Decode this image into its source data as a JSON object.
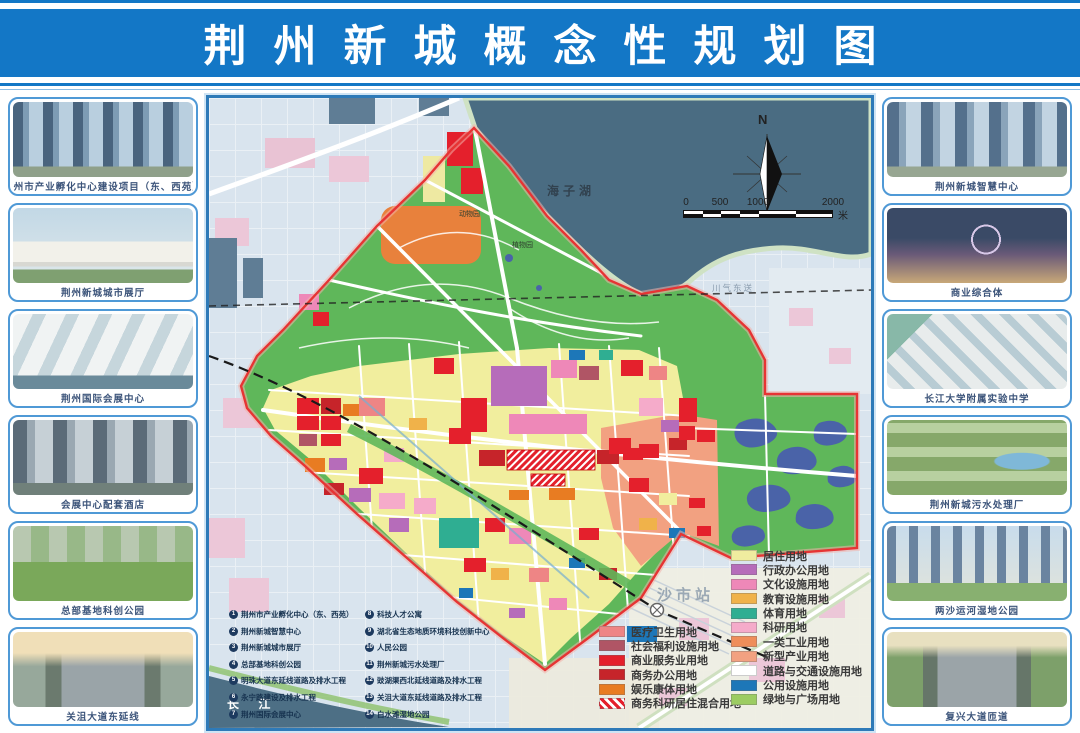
{
  "header": {
    "title": "荆州新城概念性规划图"
  },
  "left_panel": [
    {
      "caption": "荆州市产业孵化中心建设项目（东、西苑）"
    },
    {
      "caption": "荆州新城城市展厅"
    },
    {
      "caption": "荆州国际会展中心"
    },
    {
      "caption": "会展中心配套酒店"
    },
    {
      "caption": "总部基地科创公园"
    },
    {
      "caption": "关沮大道东延线"
    }
  ],
  "right_panel": [
    {
      "caption": "荆州新城智慧中心"
    },
    {
      "caption": "商业综合体"
    },
    {
      "caption": "长江大学附属实验中学"
    },
    {
      "caption": "荆州新城污水处理厂"
    },
    {
      "caption": "两沙运河湿地公园"
    },
    {
      "caption": "复兴大道匝道"
    }
  ],
  "map": {
    "labels": {
      "lake": "海子湖",
      "zoo": "动物园",
      "garden": "植物园",
      "pipeline": "川气东送",
      "station": "沙市站",
      "river": "长 江",
      "north": "N",
      "scale_unit": "米"
    },
    "scale_ticks": [
      "0",
      "500",
      "1000",
      "2000"
    ],
    "project_list": [
      {
        "n": "1",
        "t": "荆州市产业孵化中心（东、西苑）"
      },
      {
        "n": "2",
        "t": "荆州新城智慧中心"
      },
      {
        "n": "3",
        "t": "荆州新城城市展厅"
      },
      {
        "n": "4",
        "t": "总部基地科创公园"
      },
      {
        "n": "5",
        "t": "明珠大道东延线道路及排水工程"
      },
      {
        "n": "6",
        "t": "永宁路建设及排水工程"
      },
      {
        "n": "7",
        "t": "荆州国际会展中心"
      },
      {
        "n": "8",
        "t": "科技人才公寓"
      },
      {
        "n": "9",
        "t": "湖北省生态地质环境科技创新中心"
      },
      {
        "n": "10",
        "t": "人民公园"
      },
      {
        "n": "11",
        "t": "荆州新城污水处理厂"
      },
      {
        "n": "12",
        "t": "豉湖渠西北延线道路及排水工程"
      },
      {
        "n": "13",
        "t": "关沮大道东延线道路及排水工程"
      },
      {
        "n": "14",
        "t": "白水滩湿地公园"
      }
    ],
    "legend_left": [
      {
        "label": "医疗卫生用地",
        "bg": "#ee8585"
      },
      {
        "label": "社会福利设施用地",
        "bg": "#b05565"
      },
      {
        "label": "商业服务业用地",
        "bg": "#e4202c"
      },
      {
        "label": "商务办公用地",
        "bg": "#c6242a"
      },
      {
        "label": "娱乐康体用地",
        "bg": "#e87c22"
      },
      {
        "label": "商务科研居住混合用地",
        "bg": "repeating-linear-gradient(45deg,#e4202c 0 3px,#ffffff 3px 6px)"
      }
    ],
    "legend_right": [
      {
        "label": "居住用地",
        "bg": "#efec9f"
      },
      {
        "label": "行政办公用地",
        "bg": "#b66cba"
      },
      {
        "label": "文化设施用地",
        "bg": "#ee88b8"
      },
      {
        "label": "教育设施用地",
        "bg": "#f0b24a"
      },
      {
        "label": "体育用地",
        "bg": "#2fae92"
      },
      {
        "label": "科研用地",
        "bg": "#f5abca"
      },
      {
        "label": "一类工业用地",
        "bg": "#ef8e5a"
      },
      {
        "label": "新型产业用地",
        "bg": "#f2a181"
      },
      {
        "label": "道路与交通设施用地",
        "bg": "#ffffff"
      },
      {
        "label": "公用设施用地",
        "bg": "#1d77b8"
      },
      {
        "label": "绿地与广场用地",
        "bg": "#9ccc62"
      }
    ]
  }
}
